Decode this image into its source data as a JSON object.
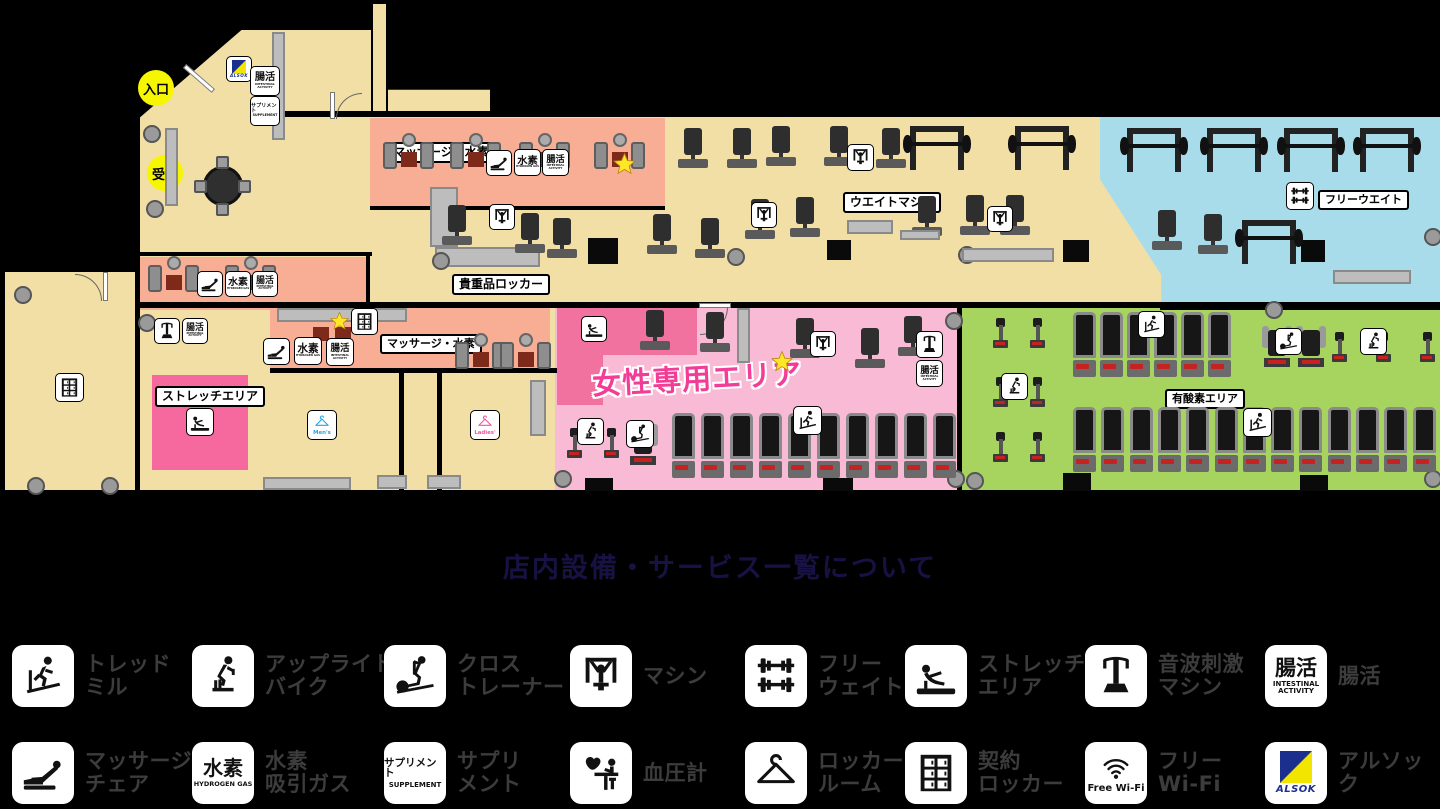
{
  "title": "店内設備・サービス一覧について",
  "colors": {
    "background": "#000000",
    "floor_beige": "#F2DFA6",
    "zone_salmon": "#F7AE94",
    "zone_blue": "#A9DCEA",
    "zone_green": "#A6D45E",
    "zone_pink_light": "#F8BAD4",
    "zone_pink_dark": "#F2729F",
    "stretch_pink": "#F5699E",
    "marker_yellow": "#F6F600",
    "women_text_pink": "#F23C96",
    "title_navy": "#181244",
    "legend_text_gray": "#3C3C3C",
    "alsok_navy": "#1B2F8F",
    "alsok_yellow": "#F2E500",
    "star_yellow": "#FFE627"
  },
  "plan": {
    "markers": {
      "entrance": "入口",
      "reception": "受付"
    },
    "area_labels": {
      "massage_hydrogen_top": "マッサージ・水素",
      "weight_machine": "ウエイトマシン",
      "free_weight": "フリーウエイト",
      "valuables_locker": "貴重品ロッカー",
      "massage_hydrogen_center": "マッサージ・水素",
      "stretch_area": "ストレッチエリア",
      "women_only": "女性専用エリア",
      "aerobic": "有酸素エリア",
      "mens_room": "Men's",
      "ladies_room": "Ladies'"
    },
    "badge_text": {
      "intestinal_jp": "腸活",
      "intestinal_en1": "INTESTINAL",
      "intestinal_en2": "ACTIVITY",
      "hydrogen_jp": "水素",
      "hydrogen_en": "HYDROGEN GAS",
      "supplement_jp": "サプリメント",
      "supplement_en": "SUPPLEMENT",
      "alsok": "ALSOK",
      "free_wifi": "Free Wi-Fi"
    }
  },
  "legend": {
    "rows": [
      [
        {
          "icon": "treadmill-icon",
          "label": "トレッドミル",
          "lines": [
            "トレッド",
            "ミル"
          ]
        },
        {
          "icon": "upright-bike-icon",
          "label": "アップライトバイク",
          "lines": [
            "アップライト",
            "バイク"
          ]
        },
        {
          "icon": "cross-trainer-icon",
          "label": "クロストレーナー",
          "lines": [
            "クロス",
            "トレーナー"
          ]
        },
        {
          "icon": "machine-icon",
          "label": "マシン",
          "lines": [
            "マシン"
          ]
        },
        {
          "icon": "free-weight-icon",
          "label": "フリーウェイト",
          "lines": [
            "フリー",
            "ウェイト"
          ]
        },
        {
          "icon": "stretch-area-icon",
          "label": "ストレッチエリア",
          "lines": [
            "ストレッチ",
            "エリア"
          ]
        },
        {
          "icon": "sonic-stimulation-machine-icon",
          "label": "音波刺激マシン",
          "lines": [
            "音波刺激",
            "マシン"
          ]
        },
        {
          "icon": "intestinal-activity-icon",
          "label": "腸活",
          "lines": [
            "腸活"
          ]
        }
      ],
      [
        {
          "icon": "massage-chair-icon",
          "label": "マッサージチェア",
          "lines": [
            "マッサージ",
            "チェア"
          ]
        },
        {
          "icon": "hydrogen-gas-icon",
          "label": "水素吸引ガス",
          "lines": [
            "水素",
            "吸引ガス"
          ]
        },
        {
          "icon": "supplement-icon",
          "label": "サプリメント",
          "lines": [
            "サプリ",
            "メント"
          ]
        },
        {
          "icon": "blood-pressure-icon",
          "label": "血圧計",
          "lines": [
            "血圧計"
          ]
        },
        {
          "icon": "locker-room-icon",
          "label": "ロッカールーム",
          "lines": [
            "ロッカー",
            "ルーム"
          ]
        },
        {
          "icon": "contract-locker-icon",
          "label": "契約ロッカー",
          "lines": [
            "契約",
            "ロッカー"
          ]
        },
        {
          "icon": "free-wifi-icon",
          "label": "フリーWi-Fi",
          "lines": [
            "フリー",
            "Wi-Fi"
          ]
        },
        {
          "icon": "alsok-icon",
          "label": "アルソック",
          "lines": [
            "アルソック"
          ]
        }
      ]
    ]
  }
}
